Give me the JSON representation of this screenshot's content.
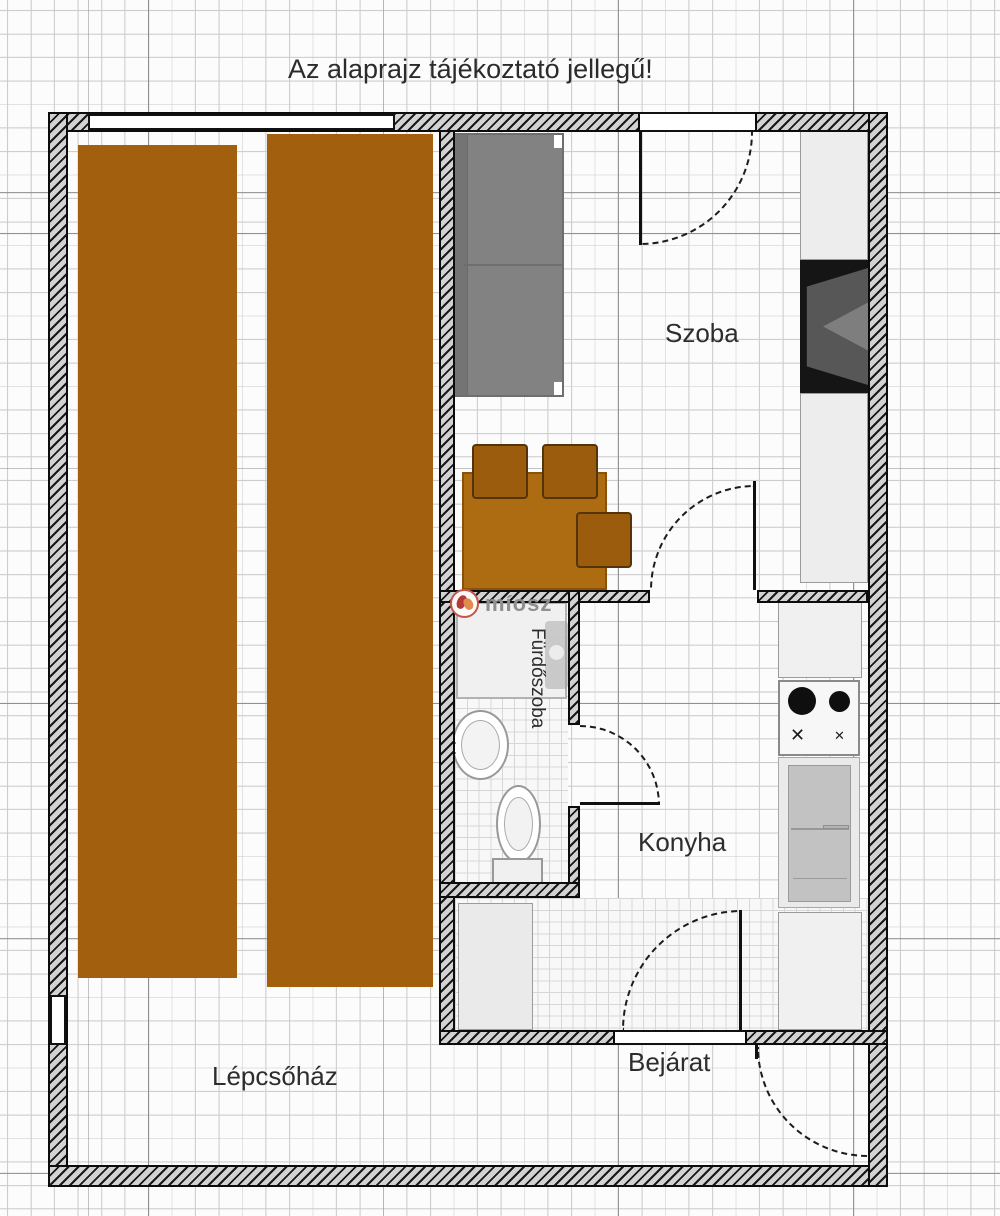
{
  "title": "Az alaprajz tájékoztató jellegű!",
  "rooms": {
    "szoba": "Szoba",
    "furdoszoba": "Fürdőszoba",
    "konyha": "Konyha",
    "bejarat": "Bejárat",
    "lepcsohaz": "Lépcsőház"
  },
  "watermark": {
    "text": "míosz"
  },
  "stove": {
    "knob_glyph_left": "✕",
    "knob_glyph_right": "✕"
  },
  "colors": {
    "stairs_brown": "#a2600f",
    "table_brown": "#ae6c12",
    "chair_brown": "#9c5c0d",
    "couch_gray": "#828282",
    "wall_fill": "#d2d2d2",
    "wall_line": "#0c0c0c",
    "cabinet_gray": "#ededed",
    "tv_black": "#151515",
    "grid_minor": "#cccccc",
    "grid_major": "#8f8f8f",
    "watermark_red": "#c8554a",
    "watermark_text_gray": "#8f8f8f"
  },
  "icons": [
    "stairs-flight",
    "couch",
    "tv-cabinet",
    "dining-table",
    "chair",
    "kitchen-counter",
    "stove-burners",
    "fridge",
    "wardrobe",
    "shower",
    "washing-machine",
    "sink",
    "toilet",
    "door-swing-arc",
    "window"
  ]
}
